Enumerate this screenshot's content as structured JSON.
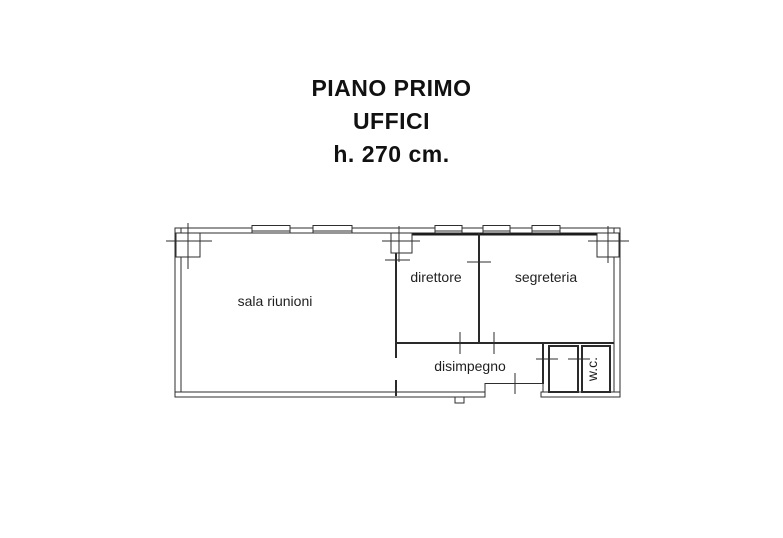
{
  "title_block": {
    "line1": "PIANO PRIMO",
    "line2": "UFFICI",
    "line3": "h. 270 cm."
  },
  "floor_plan": {
    "ink_color": "#2e2e2e",
    "background": "#ffffff",
    "rooms": [
      {
        "name": "sala riunioni"
      },
      {
        "name": "direttore"
      },
      {
        "name": "segreteria"
      },
      {
        "name": "disimpegno"
      },
      {
        "name": "w.c."
      }
    ]
  }
}
